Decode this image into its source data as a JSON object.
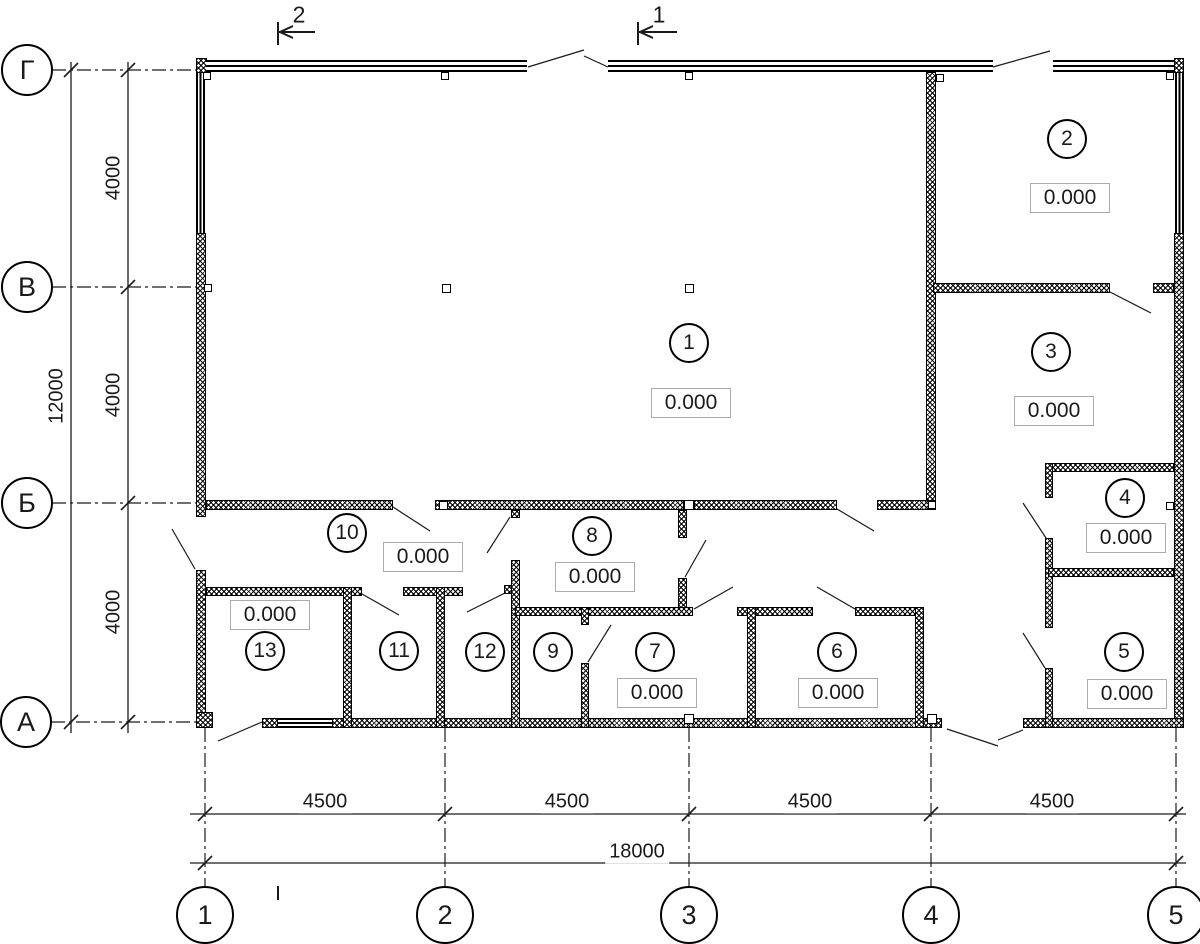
{
  "drawing_type": "floor-plan",
  "axes": {
    "rows": [
      {
        "label": "Г"
      },
      {
        "label": "В"
      },
      {
        "label": "Б"
      },
      {
        "label": "А"
      }
    ],
    "cols": [
      {
        "label": "1"
      },
      {
        "label": "2"
      },
      {
        "label": "3"
      },
      {
        "label": "4"
      },
      {
        "label": "5"
      }
    ]
  },
  "sections": [
    {
      "label": "2"
    },
    {
      "label": "1"
    }
  ],
  "dims": {
    "h_segments": [
      "4500",
      "4500",
      "4500",
      "4500"
    ],
    "h_total": "18000",
    "v_segments": [
      "4000",
      "4000",
      "4000"
    ],
    "v_total": "12000"
  },
  "rooms": [
    {
      "number": "1",
      "elevation": "0.000"
    },
    {
      "number": "2",
      "elevation": "0.000"
    },
    {
      "number": "3",
      "elevation": "0.000"
    },
    {
      "number": "4",
      "elevation": "0.000"
    },
    {
      "number": "5",
      "elevation": "0.000"
    },
    {
      "number": "6",
      "elevation": "0.000"
    },
    {
      "number": "7",
      "elevation": "0.000"
    },
    {
      "number": "8",
      "elevation": "0.000"
    },
    {
      "number": "9"
    },
    {
      "number": "10",
      "elevation": "0.000"
    },
    {
      "number": "11"
    },
    {
      "number": "12"
    },
    {
      "number": "13",
      "elevation": "0.000"
    }
  ],
  "colors": {
    "line": "#1a1a1a",
    "elev_box_border": "#ababab"
  }
}
